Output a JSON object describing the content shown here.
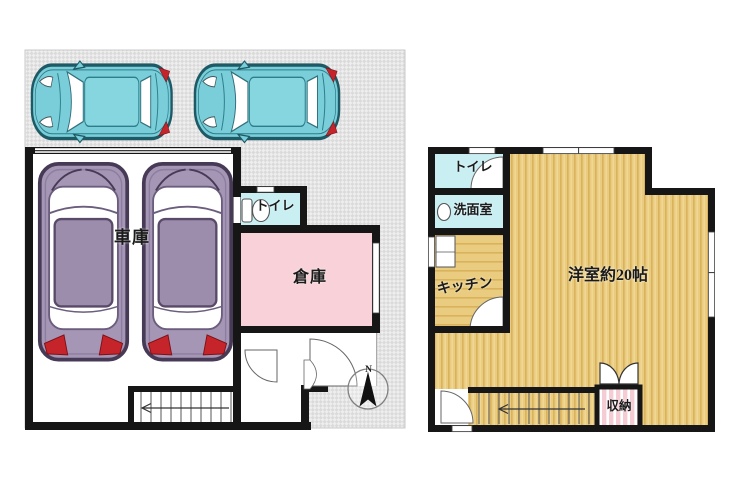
{
  "floor1": {
    "garage": "車庫",
    "warehouse": "倉庫",
    "toilet": "トイレ",
    "compass_north": "N"
  },
  "floor2": {
    "toilet": "トイレ",
    "washroom": "洗面室",
    "kitchen": "キッチン",
    "western_room": "洋室約20帖",
    "closet": "収納"
  },
  "colors": {
    "wall": "#161616",
    "lot_hatch": "#dbdada",
    "parking_car_teal": "#79ced9",
    "garage_van_purple": "#a496b4",
    "toilet_cyan": "#c9eff3",
    "warehouse_pink": "#f8d2d8",
    "wood_floor_tan": "#eacc80",
    "closet_stripe_pink": "#f6ccd4",
    "tail_light_red": "#c5242b"
  }
}
